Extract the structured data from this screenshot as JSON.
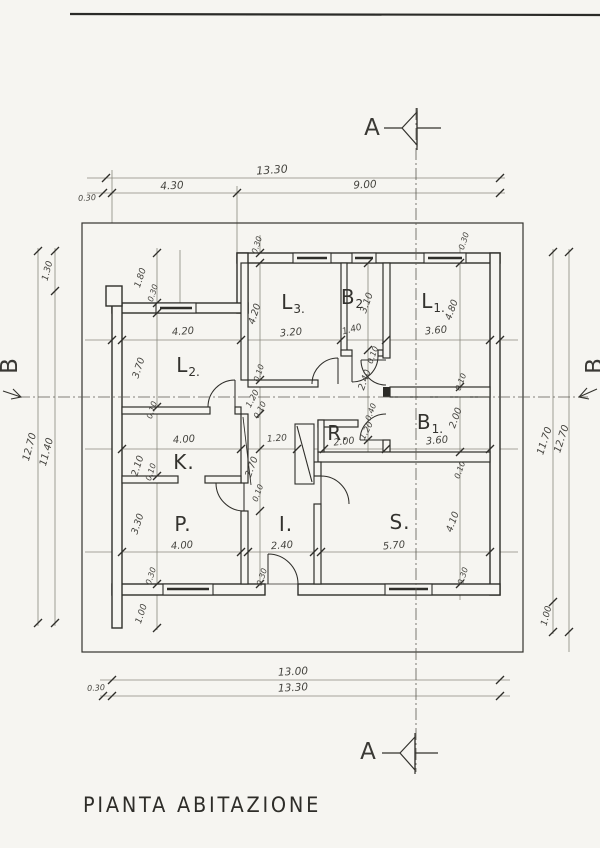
{
  "title": "PIANTA  ABITAZIONE",
  "section_markers": {
    "top": "A",
    "bottom": "A",
    "left": "B",
    "right": "B"
  },
  "rooms": [
    {
      "name": "L2",
      "main": "L",
      "sub": "2.",
      "x": 188,
      "y": 366
    },
    {
      "name": "L3",
      "main": "L",
      "sub": "3.",
      "x": 293,
      "y": 303
    },
    {
      "name": "B2",
      "main": "B",
      "sub": "2",
      "x": 352,
      "y": 298
    },
    {
      "name": "L1",
      "main": "L",
      "sub": "1.",
      "x": 433,
      "y": 302
    },
    {
      "name": "B1",
      "main": "B",
      "sub": "1.",
      "x": 430,
      "y": 423
    },
    {
      "name": "R",
      "main": "R.",
      "sub": "",
      "x": 338,
      "y": 433
    },
    {
      "name": "K",
      "main": "K.",
      "sub": "",
      "x": 184,
      "y": 462
    },
    {
      "name": "P",
      "main": "P.",
      "sub": "",
      "x": 183,
      "y": 524
    },
    {
      "name": "I",
      "main": "I.",
      "sub": "",
      "x": 286,
      "y": 524
    },
    {
      "name": "S",
      "main": "S.",
      "sub": "",
      "x": 400,
      "y": 522
    }
  ],
  "dim_labels": [
    {
      "t": "13.30",
      "x": 272,
      "y": 170,
      "r": -4,
      "s": 11
    },
    {
      "t": "4.30",
      "x": 172,
      "y": 186,
      "r": -3,
      "s": 10.5
    },
    {
      "t": "9.00",
      "x": 365,
      "y": 185,
      "r": -3,
      "s": 10.5
    },
    {
      "t": "0.30",
      "x": 87,
      "y": 198,
      "r": -3,
      "s": 8
    },
    {
      "t": "13.00",
      "x": 293,
      "y": 672,
      "r": -3,
      "s": 10.5
    },
    {
      "t": "13.30",
      "x": 293,
      "y": 688,
      "r": -3,
      "s": 10.5
    },
    {
      "t": "0.30",
      "x": 96,
      "y": 688,
      "r": -3,
      "s": 8
    },
    {
      "t": "12.70",
      "x": 30,
      "y": 447,
      "r": -75,
      "s": 10
    },
    {
      "t": "11.40",
      "x": 47,
      "y": 452,
      "r": -75,
      "s": 10
    },
    {
      "t": "1.30",
      "x": 48,
      "y": 271,
      "r": -75,
      "s": 9
    },
    {
      "t": "11.70",
      "x": 545,
      "y": 441,
      "r": -72,
      "s": 10
    },
    {
      "t": "12.70",
      "x": 562,
      "y": 439,
      "r": -72,
      "s": 10
    },
    {
      "t": "1.00",
      "x": 547,
      "y": 616,
      "r": -75,
      "s": 9
    },
    {
      "t": "4.20",
      "x": 183,
      "y": 332,
      "r": -4,
      "s": 10
    },
    {
      "t": "3.20",
      "x": 291,
      "y": 333,
      "r": -5,
      "s": 10
    },
    {
      "t": "1.40",
      "x": 352,
      "y": 330,
      "r": -15,
      "s": 9
    },
    {
      "t": "3.60",
      "x": 436,
      "y": 331,
      "r": -5,
      "s": 10
    },
    {
      "t": "4.00",
      "x": 184,
      "y": 440,
      "r": -4,
      "s": 10
    },
    {
      "t": "1.20",
      "x": 277,
      "y": 439,
      "r": -4,
      "s": 9
    },
    {
      "t": "2.00",
      "x": 344,
      "y": 442,
      "r": -6,
      "s": 9.5
    },
    {
      "t": "3.60",
      "x": 437,
      "y": 441,
      "r": -5,
      "s": 10
    },
    {
      "t": "4.00",
      "x": 182,
      "y": 546,
      "r": -4,
      "s": 10
    },
    {
      "t": "2.40",
      "x": 282,
      "y": 546,
      "r": -4,
      "s": 10
    },
    {
      "t": "5.70",
      "x": 394,
      "y": 546,
      "r": -5,
      "s": 10
    },
    {
      "t": "1.80",
      "x": 141,
      "y": 278,
      "r": -72,
      "s": 9
    },
    {
      "t": "0.30",
      "x": 153,
      "y": 293,
      "r": -72,
      "s": 8
    },
    {
      "t": "3.70",
      "x": 139,
      "y": 368,
      "r": -72,
      "s": 9.5
    },
    {
      "t": "0.10",
      "x": 152,
      "y": 410,
      "r": -72,
      "s": 8
    },
    {
      "t": "2.10",
      "x": 138,
      "y": 466,
      "r": -72,
      "s": 9.5
    },
    {
      "t": "0.10",
      "x": 151,
      "y": 472,
      "r": -72,
      "s": 8
    },
    {
      "t": "3.30",
      "x": 138,
      "y": 524,
      "r": -72,
      "s": 9.5
    },
    {
      "t": "0.30",
      "x": 151,
      "y": 576,
      "r": -72,
      "s": 8
    },
    {
      "t": "1.00",
      "x": 142,
      "y": 614,
      "r": -72,
      "s": 9
    },
    {
      "t": "0.30",
      "x": 257,
      "y": 245,
      "r": -72,
      "s": 8
    },
    {
      "t": "4.20",
      "x": 255,
      "y": 314,
      "r": -72,
      "s": 9.5
    },
    {
      "t": "0.10",
      "x": 259,
      "y": 373,
      "r": -72,
      "s": 8
    },
    {
      "t": "1.20",
      "x": 253,
      "y": 399,
      "r": -62,
      "s": 8.5
    },
    {
      "t": "0.10",
      "x": 260,
      "y": 410,
      "r": -62,
      "s": 8
    },
    {
      "t": "2.70",
      "x": 252,
      "y": 467,
      "r": -70,
      "s": 9.5
    },
    {
      "t": "0.10",
      "x": 258,
      "y": 493,
      "r": -70,
      "s": 8
    },
    {
      "t": "0.30",
      "x": 262,
      "y": 577,
      "r": -72,
      "s": 8
    },
    {
      "t": "3.10",
      "x": 367,
      "y": 303,
      "r": -70,
      "s": 9.5
    },
    {
      "t": "0.10",
      "x": 373,
      "y": 355,
      "r": -70,
      "s": 8
    },
    {
      "t": "2.40",
      "x": 365,
      "y": 380,
      "r": -70,
      "s": 9.5
    },
    {
      "t": "0.40",
      "x": 371,
      "y": 412,
      "r": -70,
      "s": 8
    },
    {
      "t": "1.20",
      "x": 367,
      "y": 431,
      "r": -62,
      "s": 8.5
    },
    {
      "t": "0.30",
      "x": 464,
      "y": 241,
      "r": -72,
      "s": 8
    },
    {
      "t": "4.80",
      "x": 452,
      "y": 310,
      "r": -70,
      "s": 9.5
    },
    {
      "t": "0.10",
      "x": 461,
      "y": 382,
      "r": -70,
      "s": 8
    },
    {
      "t": "2.00",
      "x": 456,
      "y": 418,
      "r": -70,
      "s": 9.5
    },
    {
      "t": "0.10",
      "x": 460,
      "y": 470,
      "r": -70,
      "s": 8
    },
    {
      "t": "4.10",
      "x": 453,
      "y": 522,
      "r": -70,
      "s": 9.5
    },
    {
      "t": "0.30",
      "x": 463,
      "y": 576,
      "r": -72,
      "s": 8
    }
  ]
}
